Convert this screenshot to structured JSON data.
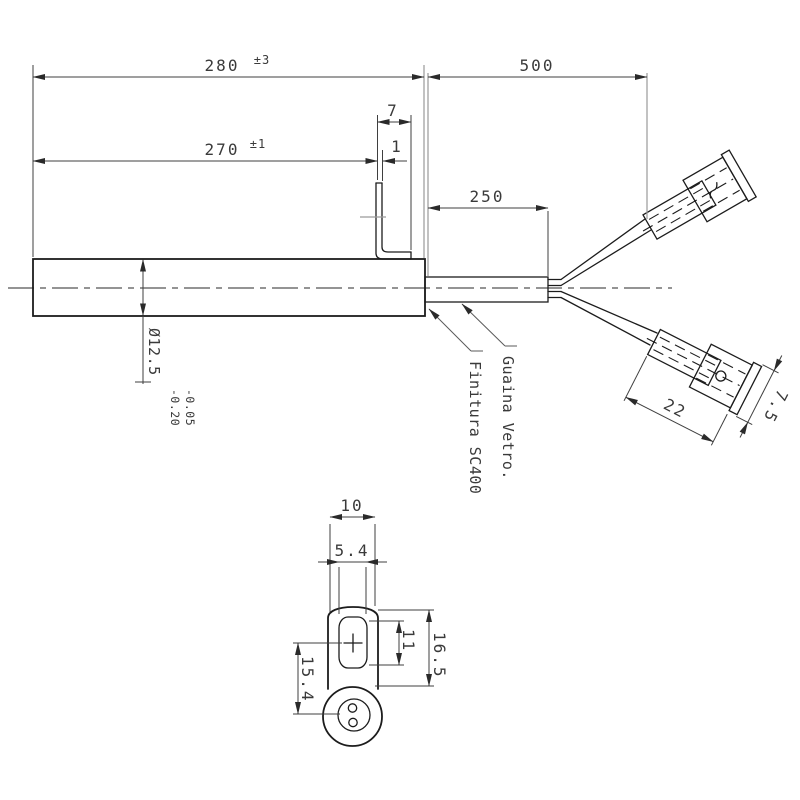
{
  "main_view": {
    "overall_length": {
      "value": "280",
      "tolerance": "±3"
    },
    "heated_length": {
      "value": "270",
      "tolerance": "±1"
    },
    "bracket_length": "7",
    "bracket_thickness": "1",
    "lead_length": "500",
    "sheath_length": "250",
    "diameter": "Ø12.5",
    "diameter_tol_upper": "-0.05",
    "diameter_tol_lower": "-0.20",
    "finish_label": "Finitura SC400",
    "sheath_label": "Guaina Vetro.",
    "terminal_length": "22",
    "terminal_width": "7.5"
  },
  "end_view": {
    "body_width": "10",
    "slot_width": "5.4",
    "slot_height": "11",
    "body_height": "16.5",
    "pin_offset": "15.4"
  },
  "colors": {
    "background": "#ffffff",
    "object_line": "#1c1c1c",
    "dimension_line": "#3f3f3f",
    "reference_line": "#9a9a9a",
    "text": "#3a3a3a"
  }
}
